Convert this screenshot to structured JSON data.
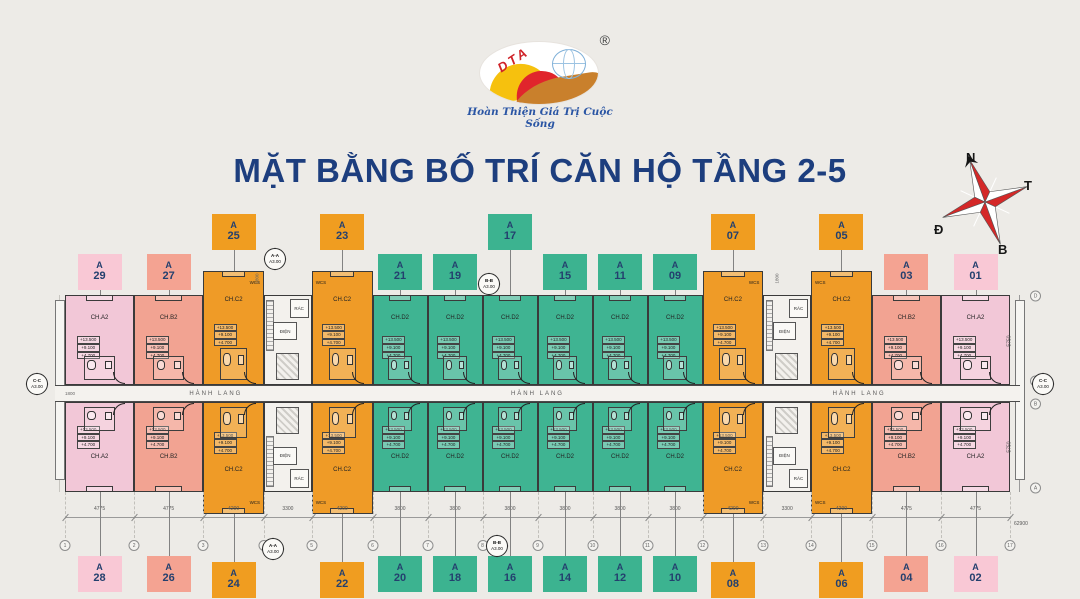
{
  "title": "MẶT BẰNG BỐ TRÍ CĂN HỘ TẦNG 2-5",
  "logo": {
    "brand": "DTA",
    "registered": "®",
    "tagline": "Hoàn Thiện Giá Trị Cuộc Sống"
  },
  "compass": {
    "top": "N",
    "right": "T",
    "left": "Đ",
    "bottom": "B"
  },
  "corridor": {
    "label": "HÀNH LANG",
    "left_dim": "1800"
  },
  "core": {
    "trash": "RÁC",
    "electric": "ĐIỆN",
    "entry_dim": "1800"
  },
  "wcs_label": "WCS",
  "elevations": [
    "+13.500",
    "+9.100",
    "+4.700"
  ],
  "section_markers": {
    "aa": {
      "name": "A-A",
      "sheet": "A3.00"
    },
    "bb": {
      "name": "B-B",
      "sheet": "A3.00"
    },
    "cc": {
      "name": "C-C",
      "sheet": "A3.00"
    }
  },
  "grid": {
    "numbers": [
      "1",
      "2",
      "3",
      "4",
      "5",
      "6",
      "7",
      "8",
      "9",
      "10",
      "11",
      "12",
      "13",
      "14",
      "15",
      "16",
      "17"
    ],
    "letters": [
      "D",
      "C",
      "B",
      "A"
    ]
  },
  "dimensions": {
    "bottom": [
      "4775",
      "4775",
      "4200",
      "3300",
      "4200",
      "3800",
      "3800",
      "3800",
      "3800",
      "3800",
      "3800",
      "4200",
      "3300",
      "4200",
      "4775",
      "4775"
    ],
    "bottom_total": "62900",
    "right_top": "5750",
    "right_mid": "1400",
    "right_bottom": "5750",
    "right_total": "12900"
  },
  "units": {
    "top": [
      {
        "callout": "A",
        "num": "29",
        "type": "CH.A2",
        "color": "pink"
      },
      {
        "callout": "A",
        "num": "27",
        "type": "CH.B2",
        "color": "salmon"
      },
      {
        "callout": "A",
        "num": "25",
        "type": "CH.C2",
        "color": "orange",
        "raised": true,
        "wcs": "sr"
      },
      {
        "kind": "core"
      },
      {
        "callout": "A",
        "num": "23",
        "type": "CH.C2",
        "color": "orange",
        "raised": true,
        "wcs": "sl"
      },
      {
        "callout": "A",
        "num": "21",
        "type": "CH.D2",
        "color": "green"
      },
      {
        "callout": "A",
        "num": "19",
        "type": "CH.D2",
        "color": "green"
      },
      {
        "callout": "A",
        "num": "17",
        "type": "CH.D2",
        "color": "green",
        "raised": true
      },
      {
        "callout": "A",
        "num": "15",
        "type": "CH.D2",
        "color": "green"
      },
      {
        "callout": "A",
        "num": "11",
        "type": "CH.D2",
        "color": "green"
      },
      {
        "callout": "A",
        "num": "09",
        "type": "CH.D2",
        "color": "green"
      },
      {
        "callout": "A",
        "num": "07",
        "type": "CH.C2",
        "color": "orange",
        "raised": true,
        "wcs": "sr"
      },
      {
        "kind": "core"
      },
      {
        "callout": "A",
        "num": "05",
        "type": "CH.C2",
        "color": "orange",
        "raised": true,
        "wcs": "sl"
      },
      {
        "callout": "A",
        "num": "03",
        "type": "CH.B2",
        "color": "salmon"
      },
      {
        "callout": "A",
        "num": "01",
        "type": "CH.A2",
        "color": "pink"
      }
    ],
    "bottom": [
      {
        "callout": "A",
        "num": "28",
        "type": "CH.A2",
        "color": "pink"
      },
      {
        "callout": "A",
        "num": "26",
        "type": "CH.B2",
        "color": "salmon"
      },
      {
        "callout": "A",
        "num": "24",
        "type": "CH.C2",
        "color": "orange",
        "wcs": "sr"
      },
      {
        "kind": "core"
      },
      {
        "callout": "A",
        "num": "22",
        "type": "CH.C2",
        "color": "orange",
        "wcs": "sl"
      },
      {
        "callout": "A",
        "num": "20",
        "type": "CH.D2",
        "color": "green"
      },
      {
        "callout": "A",
        "num": "18",
        "type": "CH.D2",
        "color": "green"
      },
      {
        "callout": "A",
        "num": "16",
        "type": "CH.D2",
        "color": "green"
      },
      {
        "callout": "A",
        "num": "14",
        "type": "CH.D2",
        "color": "green"
      },
      {
        "callout": "A",
        "num": "12",
        "type": "CH.D2",
        "color": "green"
      },
      {
        "callout": "A",
        "num": "10",
        "type": "CH.D2",
        "color": "green"
      },
      {
        "callout": "A",
        "num": "08",
        "type": "CH.C2",
        "color": "orange",
        "wcs": "sr"
      },
      {
        "kind": "core"
      },
      {
        "callout": "A",
        "num": "06",
        "type": "CH.C2",
        "color": "orange",
        "wcs": "sl"
      },
      {
        "callout": "A",
        "num": "04",
        "type": "CH.B2",
        "color": "salmon"
      },
      {
        "callout": "A",
        "num": "02",
        "type": "CH.A2",
        "color": "pink"
      }
    ]
  },
  "colors": {
    "pink": "#f2c7d7",
    "salmon": "#f2a392",
    "orange": "#ef9b27",
    "green": "#3fb492",
    "navy": "#1d3e7e"
  }
}
